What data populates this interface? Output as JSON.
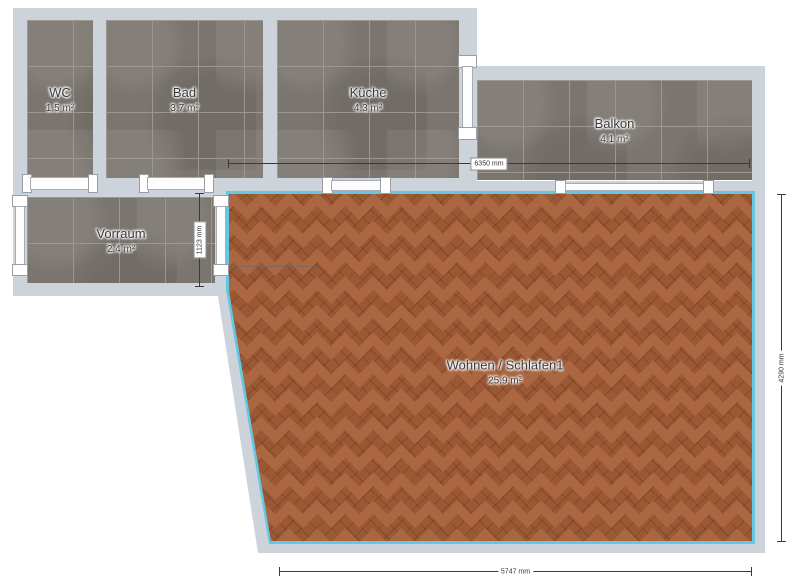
{
  "app": {
    "view": "floor-plan"
  },
  "rooms": [
    {
      "name": "WC",
      "area": "1.5 m²",
      "floor": "tile"
    },
    {
      "name": "Bad",
      "area": "3.7 m²",
      "floor": "tile"
    },
    {
      "name": "Küche",
      "area": "4.3 m²",
      "floor": "tile"
    },
    {
      "name": "Balkon",
      "area": "4.1 m²",
      "floor": "tile"
    },
    {
      "name": "Vorraum",
      "area": "2.4 m²",
      "floor": "tile"
    },
    {
      "name": "Wohnen / Schlafen1",
      "area": "25.9 m²",
      "floor": "parquet-herringbone"
    }
  ],
  "dimensions": {
    "top": "6350 mm",
    "vorraum_height": "1123 mm",
    "right": "4290 mm",
    "bottom": "5747 mm"
  },
  "colors": {
    "wall": "#ccd3da",
    "tile": "#7b756f",
    "tile_grout": "#9d978f",
    "parquet": "#9a5834",
    "room_border": "#66c7e3",
    "dimension_line": "#3a3a3e"
  }
}
